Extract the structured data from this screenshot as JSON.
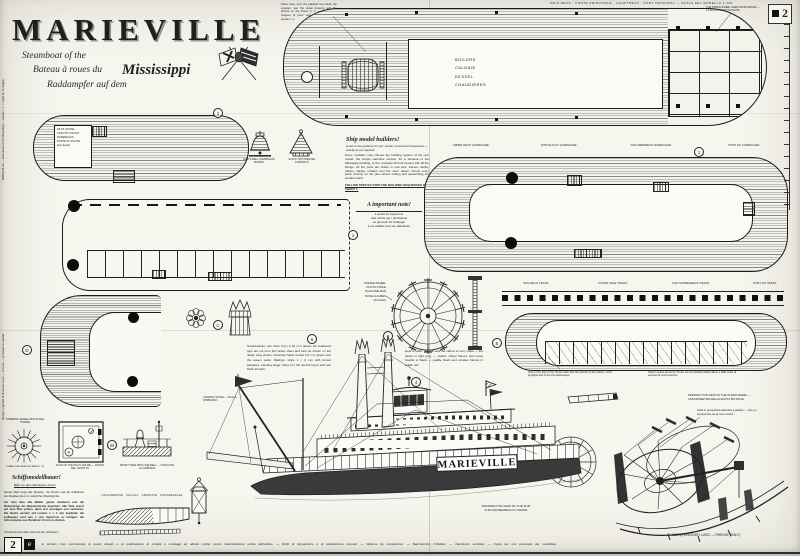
{
  "sheet": {
    "corner_number": "2",
    "block_number": "2",
    "block_letter": "e",
    "edge_note_top": "MARIEVILLE — steamboat of the Mississippi — tavola n. 2 — foglio di montaggio",
    "edge_note_bottom": "disegno originale di Vincenzo Lusci — Firenze — riproduzione vietata",
    "legal_line": "È proibito l'uso commerciale di questi disegni e la realizzazione di modelli e montaggi ad attività mobile senza l'autorizzazione scritta dell'editore.  —  Diritti di riproduzione e di realizzazione riservati.  —  Défense de reproduction.  —  Reproduction forbidden.  —  Nachdruck verboten.  —  Copia per uso personale del modellista.",
    "copyright": "© 1969 by VINCENZO LUSCI — FIRENZE (ITALY)"
  },
  "title_block": {
    "title": "MARIEVILLE",
    "subtitle_en": "Steamboat of the",
    "subtitle_fr": "Bateau à roues du",
    "subtitle_de": "Raddampfer auf dem",
    "river": "Mississippi"
  },
  "top_plan": {
    "header": "MAIN DECK · PONTE PRINCIPALE · HAUPTDECK · PONT PRINCIPAL — SCALA DEL MODELLO 1:100",
    "note": "Place here, over the planked fore deck, the capstan: see the detail drawing and the photos on the sheet nr. 1. — Mettere qui l'argano di prua: vedi il particolare sulla tavola n. 1.",
    "cabin": "BOILERS\nCALDAIE\nKESSEL\nCHAUDIÈRES",
    "wheel_note": "THE STERN WHEEL SEEN FROM ABOVE — LA RUOTA VISTA IN PIANTA"
  },
  "plans": {
    "texas_left_box": "PILOT HOUSE\nCASOTTO PILOTA\nRUDERHAUS\nPOSTE DU PILOTE\n(see detail)",
    "hurricane_labels": [
      "UPPER DECK 'HURRICANE'",
      "PONTE ALTO 'HURRICANE'",
      "DAS OBERDECK 'HURRICANE'",
      "PONT DU 'HURRICANE'"
    ],
    "texas_labels": [
      "SUN DECK 'TEXAS'",
      "PONTE SOLE 'TEXAS'",
      "DAS SONNENDECK 'TEXAS'",
      "PONT DU 'TEXAS'"
    ],
    "texas_caption_left": "View of the plan of the 'Texas' deck with the position of the cabins, of the skylights and of the companionways.",
    "texas_caption_right": "Vista in pianta del ponte 'Texas' con la posizione delle cabine e delle scale di accesso ai ponti superiori."
  },
  "center_notes": {
    "heading": "Ship model builders!",
    "sub": "at last a new guidance for you: simple, correct and inexpensive — exactly as you wanted!",
    "body": "Every modeller may choose the building system of his own model: the simple waterline version, for a diorama of the Mississippi landing, or the complete full hull version with all the fittings. All the parts are drawn in real size: frames, decks, cabins, stacks, rudders and the stern wheel. Check every piece directly on the plan before cutting and assembling the wooden parts.",
    "emphasis": "FOLLOW STEP BY STEP THE BUILDING SEQUENCES OF SHEET 1.",
    "heading2": "A important note!",
    "body2": "it works for beginners\nvale anche per i principianti\nes gilt auch für Anfänger\nil est valable pour les débutants"
  },
  "wheel_detail": {
    "label": "PADDLE WHEEL\nRUOTA A PALE\nSCHAUFELRAD\nROUE À AUBES\n(24 floats)"
  },
  "perspective": {
    "name": "MARIEVILLE",
    "note_left": "Smokestacks: turn them from a 10 mm dowel; the feathered tops are cut from thin brass sheet and bent as shown on the detail. Hog chains: stretched black thread 0,5 mm glued over the queen posts. Railings: strips 1 × 2 mm with turned balusters. Landing stage: hang it to the derrick boom with two black threads.",
    "note_right": "How to paint: the hull and the cabins in ivory white — the decks in light grey — stacks, wheel frames and name boards in black — paddle floats and window frames in indian red.",
    "landing_note": "LANDING STAGE — SCALA D'IMBARCO",
    "caption": "PERSPECTIVE VIEW OF THE SHIP\nVUE D'ENSEMBLE DU NAVIRE"
  },
  "stern_detail": {
    "note1": "PERSPECTIVE VIEW OF THE STERN WHEEL — ASSONOMETRIA DELLA RUOTA MOTRICE",
    "note2": "Vista in prospettiva dell'elica a palette — Vue en perspective de la roue arrière."
  },
  "bottom_left": {
    "sw_top": "STEERING WHEEL RUOTA DEL TIMONE",
    "sw_bottom": "(make it as shown on sheet n. 1)",
    "plan_caption": "PLAN OF THE PILOT HOUSE — PIANTA DEL CASOTTO",
    "front_caption": "FRONT VIEW WITH THE BELL — VISTA CON LA CAMPANA",
    "german_heading": "Schiffsmodellbauer!",
    "german_sub": "Bitte vor dem Baubeginn lesen!",
    "german_p1": "Dieses Blatt zeigt alle Spanten, die Decks und die Aufbauten des Raddampfers in natürlicher Modellgröße.",
    "german_p2": "Vor dem Bau alle Blätter genau studieren und die Reihenfolge der Bauabschnitte beachten. Alle Teile zuerst auf dem Plan prüfen, dann erst aussägen und verleimen. Die Decks werden mit Leisten 1 × 4 mm beplankt; die Aufbauten sind aus 1 mm Sperrholz zu fertigen; die Schornsteine aus Rundholz 10 mm zu drehen.",
    "german_last": "Viel Erfolg beim Bau wünscht der Verfasser!",
    "hull_labels": "LONGHERONE · CHIGLIA · ORDINATE · PARAMEZZALE"
  },
  "small_details": {
    "bell_label": "SHIP'S BELL CAMPANA DI BORDO",
    "cone_label": "STACK TOP CIMA DEL FUMAIOLO"
  },
  "markers": {
    "texas_left": "1",
    "hurricane": "1",
    "texas_right": "E",
    "center": "1",
    "bow": "D",
    "pilot_m": "M",
    "flower": "C",
    "ph_plan": "A",
    "persp_a": "6",
    "persp_b": "5",
    "persp_c": "4"
  }
}
